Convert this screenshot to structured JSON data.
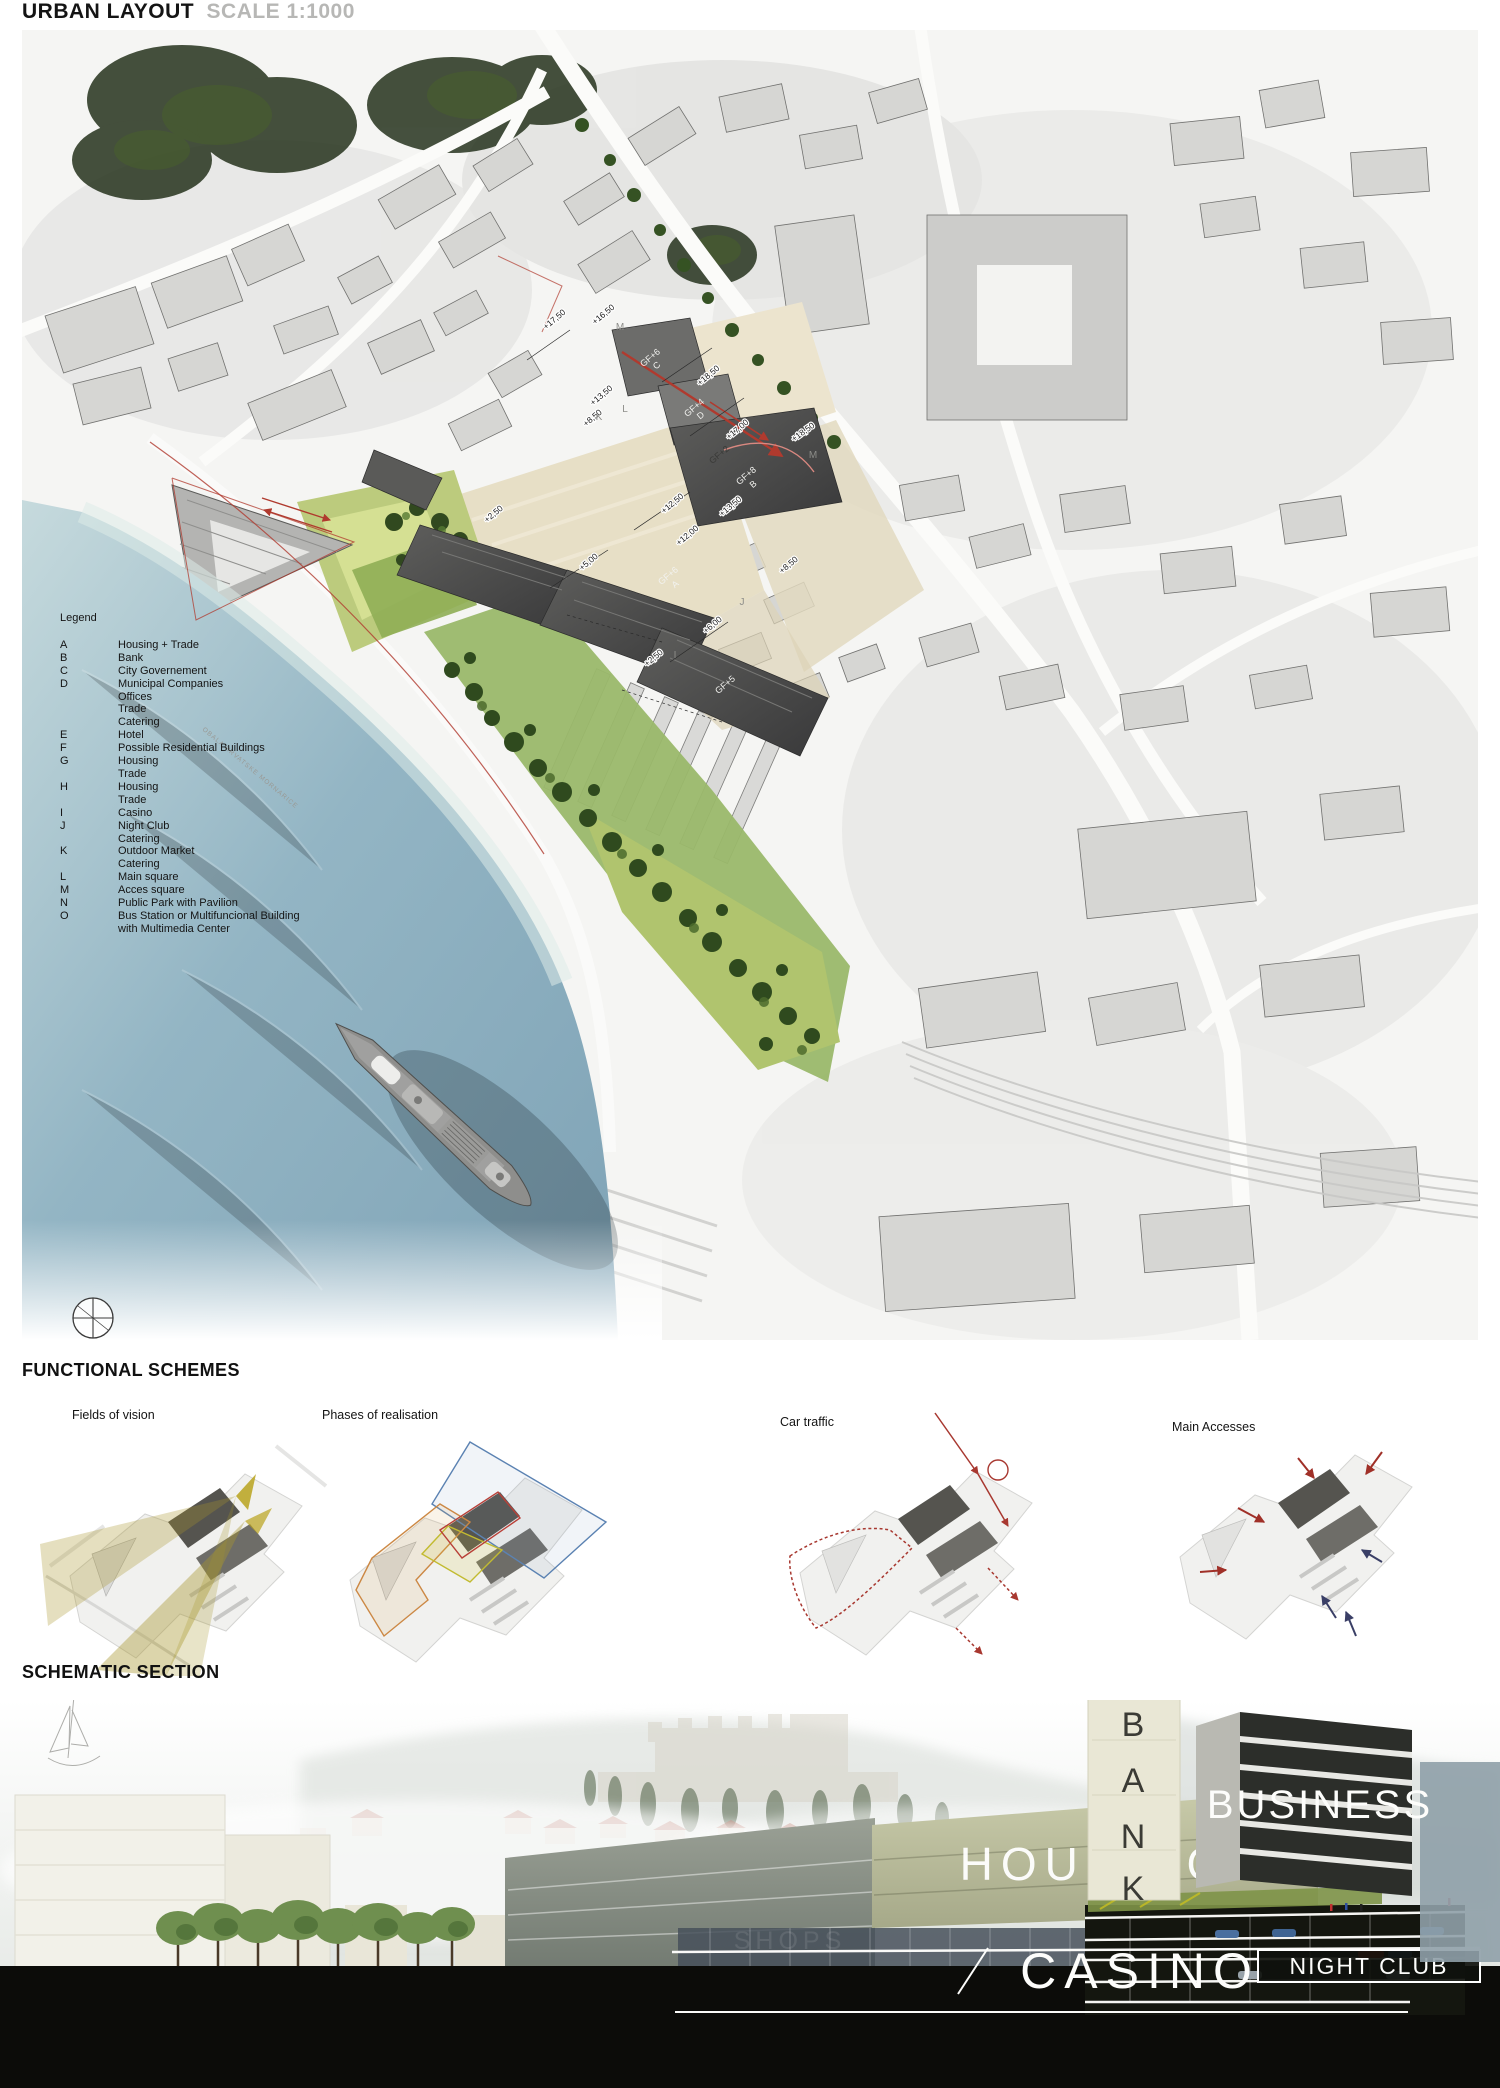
{
  "header": {
    "title": "URBAN LAYOUT",
    "scale": "SCALE 1:1000"
  },
  "colors": {
    "annotation_red": "#b03a2e",
    "sea_deep": "#7fa6ba",
    "sea_shallow": "#c2d8dc",
    "park_green": "#9ab86a",
    "tree_dark": "#2f4a1e",
    "project_dark": "#4a4a48",
    "plaza_beige": "#e7dfc6",
    "vision_fan": "#a89628"
  },
  "map": {
    "street_label": "OBALA HRVATSKE MORNARICE",
    "legend": {
      "title": "Legend",
      "rows": [
        {
          "key": "A",
          "text": "Housing + Trade"
        },
        {
          "key": "B",
          "text": "Bank"
        },
        {
          "key": "C",
          "text": "City Governement"
        },
        {
          "key": "D",
          "text": "Municipal Companies"
        },
        {
          "key": "",
          "text": "Offices"
        },
        {
          "key": "",
          "text": "Trade"
        },
        {
          "key": "",
          "text": "Catering"
        },
        {
          "key": "E",
          "text": "Hotel"
        },
        {
          "key": "F",
          "text": "Possible Residential Buildings"
        },
        {
          "key": "G",
          "text": "Housing"
        },
        {
          "key": "",
          "text": "Trade"
        },
        {
          "key": "H",
          "text": "Housing"
        },
        {
          "key": "",
          "text": "Trade"
        },
        {
          "key": "I",
          "text": "Casino"
        },
        {
          "key": "J",
          "text": "Night Club"
        },
        {
          "key": "",
          "text": "Catering"
        },
        {
          "key": "K",
          "text": "Outdoor Market"
        },
        {
          "key": "",
          "text": "Catering"
        },
        {
          "key": "L",
          "text": "Main square"
        },
        {
          "key": "M",
          "text": "Acces square"
        },
        {
          "key": "N",
          "text": "Public Park with Pavilion"
        },
        {
          "key": "O",
          "text": "Bus Station or Multifuncional Building"
        },
        {
          "key": "",
          "text": "with Multimedia Center"
        }
      ]
    },
    "elevations": [
      "+18,50",
      "+17,00",
      "+18,50",
      "+17,50",
      "+16,50",
      "+13,50",
      "+8,50",
      "+12,50",
      "+13,50",
      "+12,00",
      "+5,00",
      "+8,50",
      "+6,00",
      "+2,50",
      "+2,50"
    ],
    "building_labels": [
      {
        "gf": "GF+8",
        "zone": "B"
      },
      {
        "gf": "GF+6",
        "zone": "A"
      },
      {
        "gf": "GF+6",
        "zone": "C"
      },
      {
        "gf": "GF+4",
        "zone": "D"
      },
      {
        "gf": "GF+2",
        "zone": ""
      },
      {
        "gf": "GF+5",
        "zone": ""
      }
    ],
    "zone_letters": [
      "K",
      "L",
      "M",
      "M",
      "J",
      "I"
    ]
  },
  "functional_schemes": {
    "title": "FUNCTIONAL SCHEMES",
    "schemes": [
      {
        "label": "Fields of vision"
      },
      {
        "label": "Phases of realisation"
      },
      {
        "label": "Car traffic"
      },
      {
        "label": "Main Accesses"
      }
    ]
  },
  "section": {
    "title": "SCHEMATIC SECTION",
    "labels": {
      "bank_letters": [
        "B",
        "A",
        "N",
        "K"
      ],
      "business": "BUSINESS",
      "housing": "HOUSING",
      "shops": "SHOPS",
      "casino": "CASINO",
      "night_club": "NIGHT CLUB"
    }
  }
}
